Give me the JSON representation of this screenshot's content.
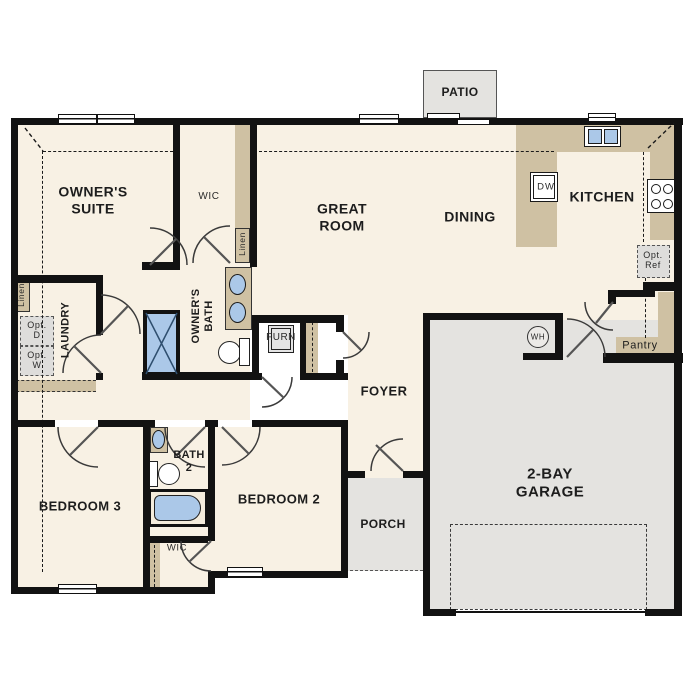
{
  "plan": {
    "rooms": {
      "owners_suite": {
        "label": "OWNER'S\nSUITE"
      },
      "owners_wic": {
        "label": "WIC"
      },
      "owners_bath": {
        "label": "OWNER'S\nBATH"
      },
      "laundry": {
        "label": "LAUNDRY"
      },
      "great_room": {
        "label": "GREAT\nROOM"
      },
      "dining": {
        "label": "DINING"
      },
      "kitchen": {
        "label": "KITCHEN"
      },
      "foyer": {
        "label": "FOYER"
      },
      "bedroom_2": {
        "label": "BEDROOM 2"
      },
      "bedroom_3": {
        "label": "BEDROOM 3"
      },
      "bath_2": {
        "label": "BATH\n2"
      },
      "bedroom_2_wic": {
        "label": "WIC"
      },
      "pantry": {
        "label": "Pantry"
      }
    },
    "outdoor": {
      "patio": {
        "label": "PATIO"
      },
      "porch": {
        "label": "PORCH"
      },
      "garage": {
        "label": "2-BAY\nGARAGE"
      }
    },
    "fixtures": {
      "dishwasher": "DW",
      "water_heater": "WH",
      "furnace": "FURN",
      "opt_dryer": "Opt.\nD",
      "opt_washer": "Opt.\nW",
      "opt_fridge": "Opt.\nRef",
      "linen_owners": "Linen",
      "linen_laundry": "Linen"
    },
    "colors": {
      "wall": "#121212",
      "floor": "#f8f1e4",
      "counter": "#cfc1a3",
      "outdoor_gray": "#e4e3e0",
      "fixture_blue": "#abc8e8"
    }
  }
}
